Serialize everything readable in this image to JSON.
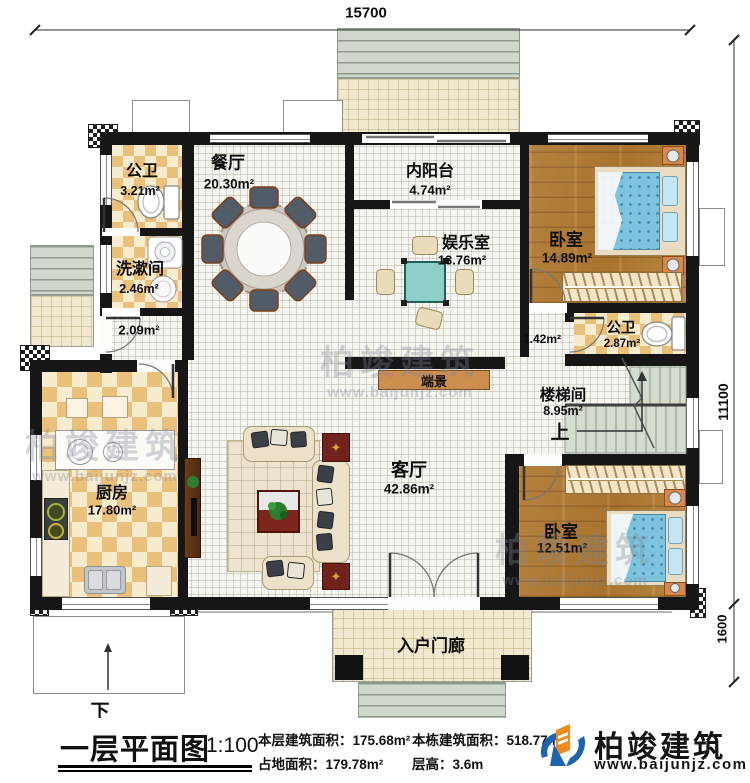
{
  "dimensions": {
    "top_width": "15700",
    "right_height": "11100",
    "porch_depth": "1600"
  },
  "rooms": [
    {
      "id": "bath1",
      "name": "公卫",
      "area": "3.21m²"
    },
    {
      "id": "washroom",
      "name": "洗漱间",
      "area": "2.46m²"
    },
    {
      "id": "dining",
      "name": "餐厅",
      "area": "20.30m²"
    },
    {
      "id": "balcony",
      "name": "内阳台",
      "area": "4.74m²"
    },
    {
      "id": "recreation",
      "name": "娱乐室",
      "area": "13.76m²"
    },
    {
      "id": "bedroom1",
      "name": "卧室",
      "area": "14.89m²"
    },
    {
      "id": "bath2",
      "name": "公卫",
      "area": "2.87m²"
    },
    {
      "id": "stairwell",
      "name": "楼梯间",
      "area": "8.95m²"
    },
    {
      "id": "kitchen",
      "name": "厨房",
      "area": "17.80m²"
    },
    {
      "id": "living",
      "name": "客厅",
      "area": "42.86m²"
    },
    {
      "id": "bedroom2",
      "name": "卧室",
      "area": "12.51m²"
    },
    {
      "id": "porch",
      "name": "入户门廊",
      "area": ""
    }
  ],
  "small_areas": {
    "hall_left": "2.09m²",
    "hall_right": "1.42m²"
  },
  "annotations": {
    "stairs_up": "上",
    "ramp_down": "下",
    "console": "端景"
  },
  "title_block": {
    "plan_title": "一层平面图",
    "scale": "1:100",
    "floor_area_label": "本层建筑面积：",
    "floor_area_value": "175.68m²",
    "site_area_label": "占地面积：",
    "site_area_value": "179.78m²",
    "building_area_label": "本栋建筑面积：",
    "building_area_value": "518.77m²",
    "floor_height_label": "层高：",
    "floor_height_value": "3.6m"
  },
  "brand": {
    "name": "柏竣建筑",
    "website": "www.baijunjz.com"
  },
  "icons": {
    "table_star": "✦"
  }
}
